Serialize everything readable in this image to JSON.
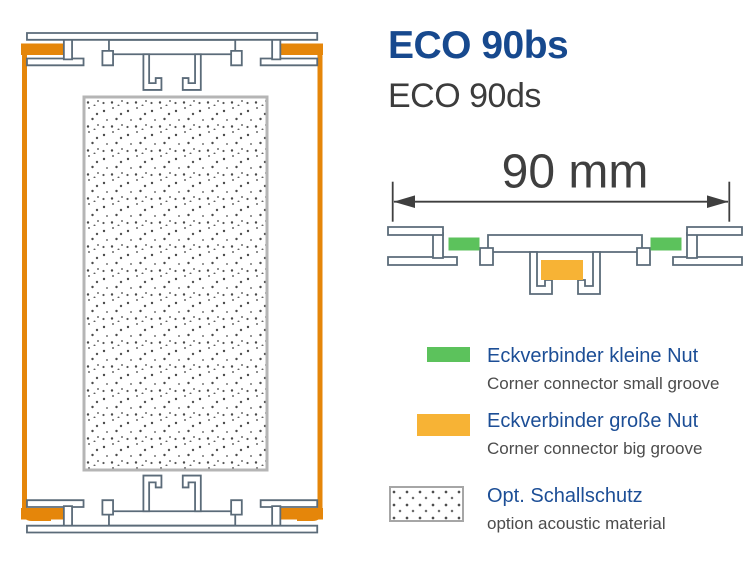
{
  "header": {
    "title": "ECO 90bs",
    "subtitle": "ECO 90ds"
  },
  "dimension": {
    "label": "90 mm"
  },
  "legend": [
    {
      "id": "corner-connector-small-groove",
      "swatch": "green",
      "color": "#5cc25c",
      "label_de": "Eckverbinder kleine Nut",
      "label_en": "Corner connector small groove"
    },
    {
      "id": "corner-connector-big-groove",
      "swatch": "orange",
      "color": "#f7b335",
      "label_de": "Eckverbinder große Nut",
      "label_en": "Corner connector big groove"
    },
    {
      "id": "optional-acoustic-material",
      "swatch": "dotted",
      "color": "",
      "label_de": "Opt. Schallschutz",
      "label_en": "option acoustic material"
    }
  ],
  "colors": {
    "title_blue": "#17498e",
    "legend_blue": "#1c4e96",
    "profile_outline_gray": "#5b6b79",
    "frame_orange": "#e5860a",
    "small_groove_green": "#5cc25c",
    "big_groove_orange": "#f7b335",
    "dimension_text_gray": "#3f3f3f",
    "panel_border_gray": "#b5b5b5"
  }
}
